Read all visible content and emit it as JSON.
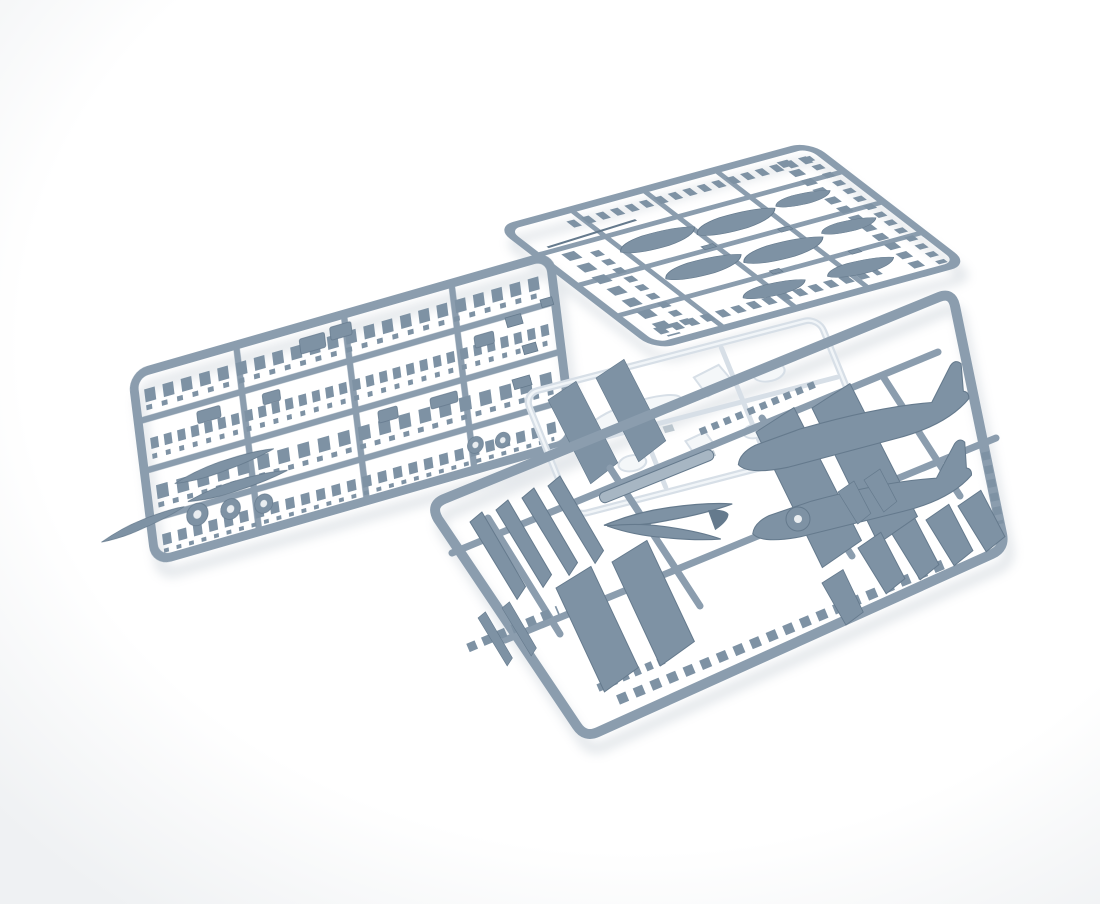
{
  "scene": {
    "type": "product photograph",
    "description": "Three blue-grey injection-moulded plastic model kit sprues with aircraft parts and one clear sprue, overlapping on a white studio background",
    "background": "#ffffff",
    "vignette": "#eff1f3"
  },
  "colors": {
    "runner": "#8b9dae",
    "part_mid": "#7e92a4",
    "part_dark": "#657a8d",
    "part_light": "#a7b6c3",
    "clear_stroke": "#d7dfe7",
    "clear_fill": "#f4f7f9",
    "seen_through": "#a9b7c2",
    "shadow": "#bfc8d0"
  },
  "sprues": {
    "detail": {
      "label": "detail parts sprue",
      "contents": "cockpit parts, propeller blades, wheels, undercarriage and many small parts in dense rows",
      "wheels": 5,
      "propeller_blades": 3
    },
    "stores": {
      "label": "external stores sprue",
      "contents": "drop tanks and bombs plus leaning columns of small stores",
      "drop_tanks": 8
    },
    "airframe": {
      "label": "airframe sprue",
      "contents": "two fuselage halves, large tapered wing panels, propeller with spinner disc and landing gear doors",
      "fuselage_halves": 2,
      "wing_panels": 4,
      "gear_doors": 7
    },
    "clear": {
      "label": "clear parts sprue",
      "contents": "canopy, windscreen and small transparent parts",
      "canopy_parts": 6
    }
  }
}
